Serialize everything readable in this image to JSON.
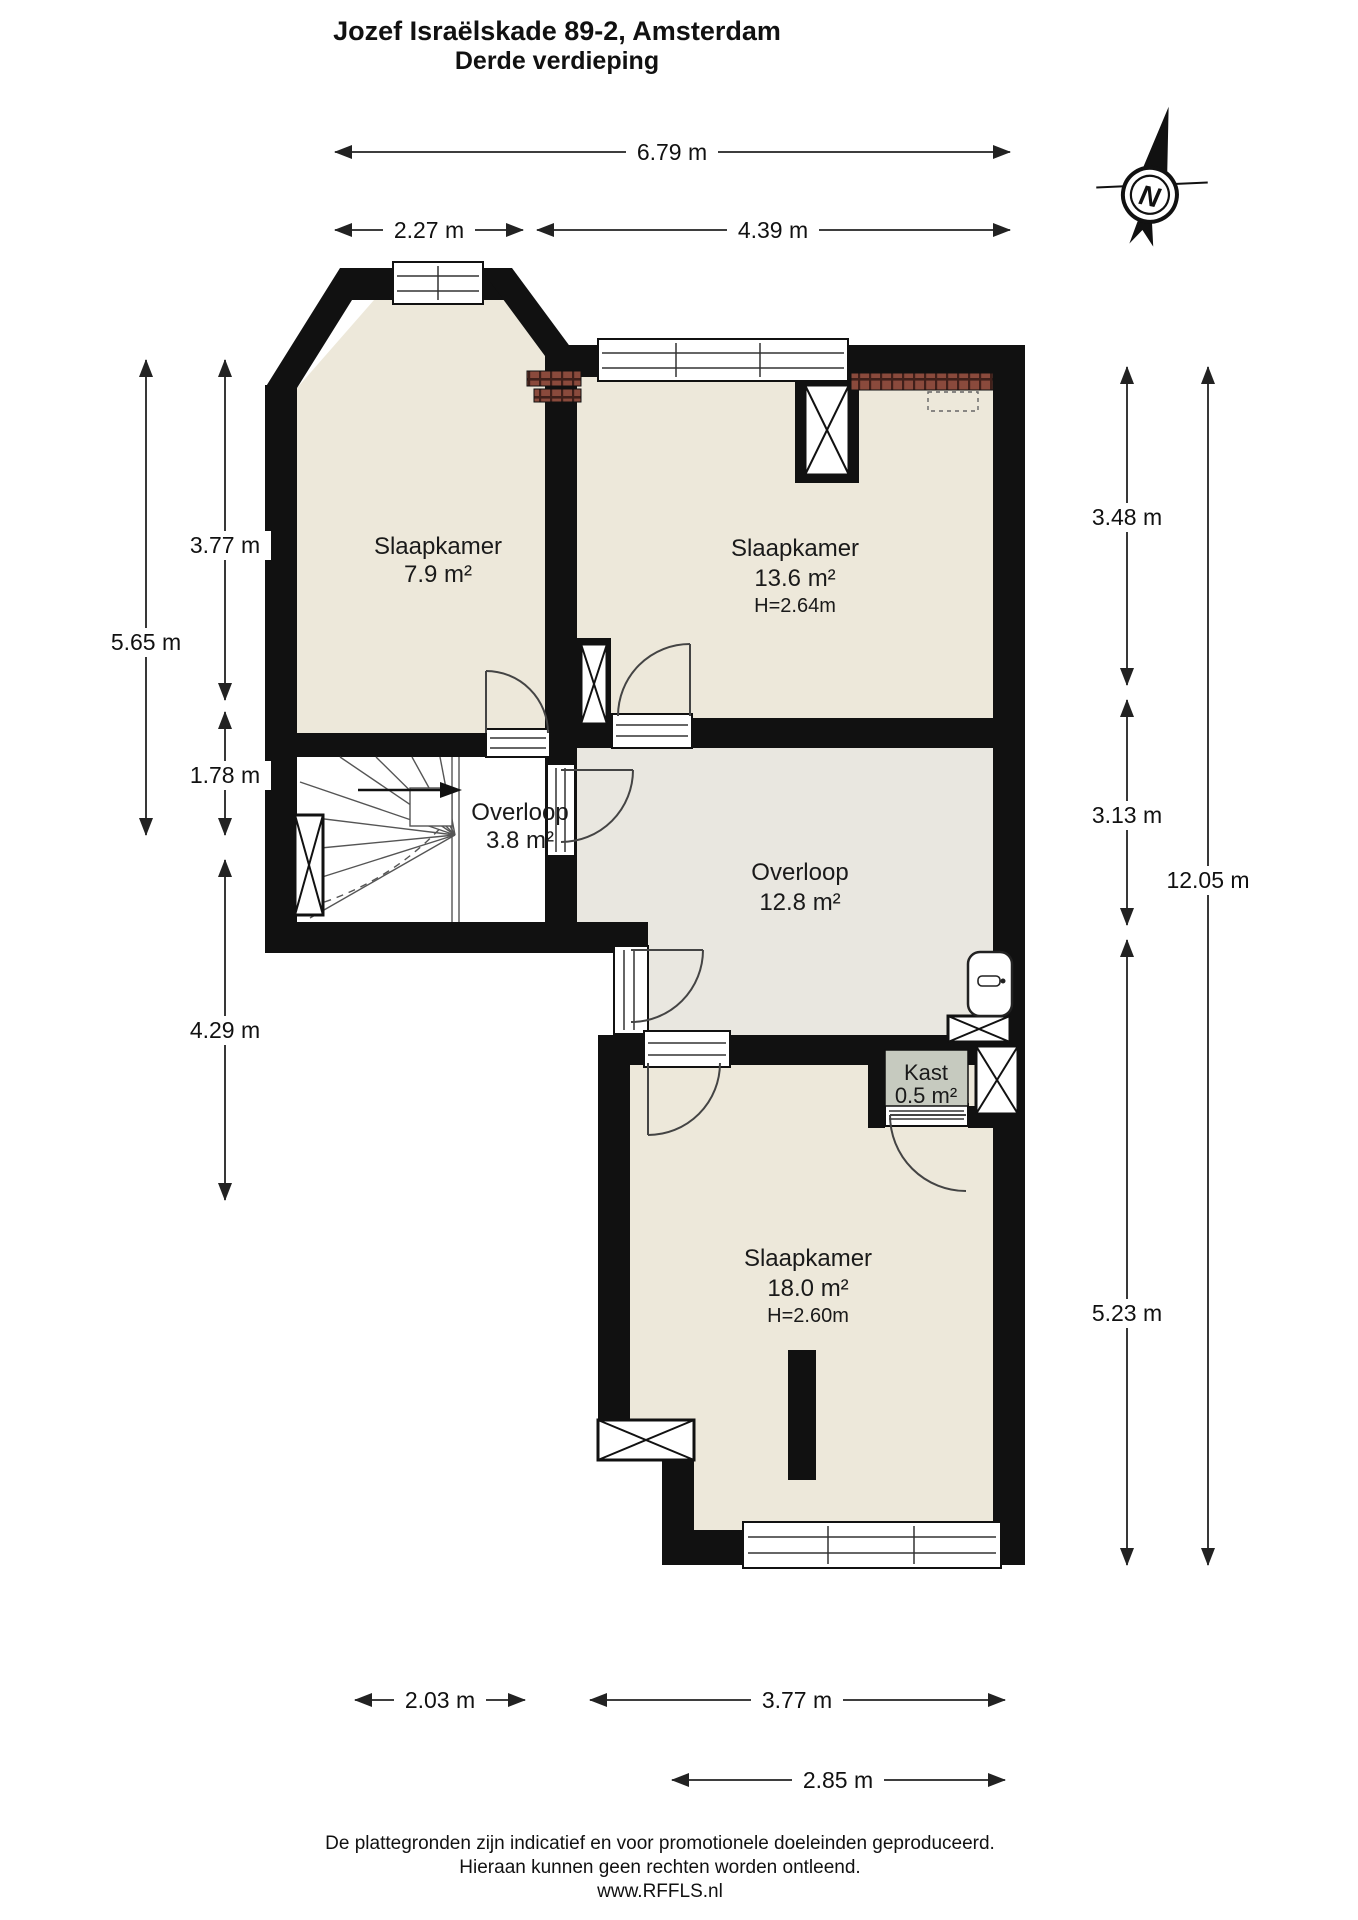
{
  "header": {
    "title": "Jozef Israëlskade 89-2, Amsterdam",
    "subtitle": "Derde verdieping"
  },
  "compass": {
    "label": "N"
  },
  "rooms": {
    "bedroom_small": {
      "name": "Slaapkamer",
      "area": "7.9 m²"
    },
    "bedroom_mid": {
      "name": "Slaapkamer",
      "area": "13.6 m²",
      "height": "H=2.64m"
    },
    "landing_small": {
      "name": "Overloop",
      "area": "3.8 m²"
    },
    "landing_large": {
      "name": "Overloop",
      "area": "12.8 m²"
    },
    "closet": {
      "name": "Kast",
      "area": "0.5 m²"
    },
    "bedroom_large": {
      "name": "Slaapkamer",
      "area": "18.0 m²",
      "height": "H=2.60m"
    }
  },
  "dimensions": {
    "top_total": "6.79 m",
    "top_left": "2.27 m",
    "top_right": "4.39 m",
    "left_outer": "5.65 m",
    "left_upper": "3.77 m",
    "left_mid": "1.78 m",
    "left_lower": "4.29 m",
    "right_upper": "3.48 m",
    "right_mid": "3.13 m",
    "right_lower": "5.23 m",
    "right_total": "12.05 m",
    "bottom_left": "2.03 m",
    "bottom_mid": "3.77 m",
    "bottom_inner": "2.85 m"
  },
  "footer": {
    "line1": "De plattegronden zijn indicatief en voor promotionele doeleinden geproduceerd.",
    "line2": "Hieraan kunnen geen rechten worden ontleend.",
    "line3": "www.RFFLS.nl"
  },
  "colors": {
    "wall": "#111111",
    "floor_bedroom": "#EDE8DA",
    "floor_landing": "#E9E7E0",
    "closet_fill": "#C6CABF",
    "brick": "#8A4A3C"
  }
}
